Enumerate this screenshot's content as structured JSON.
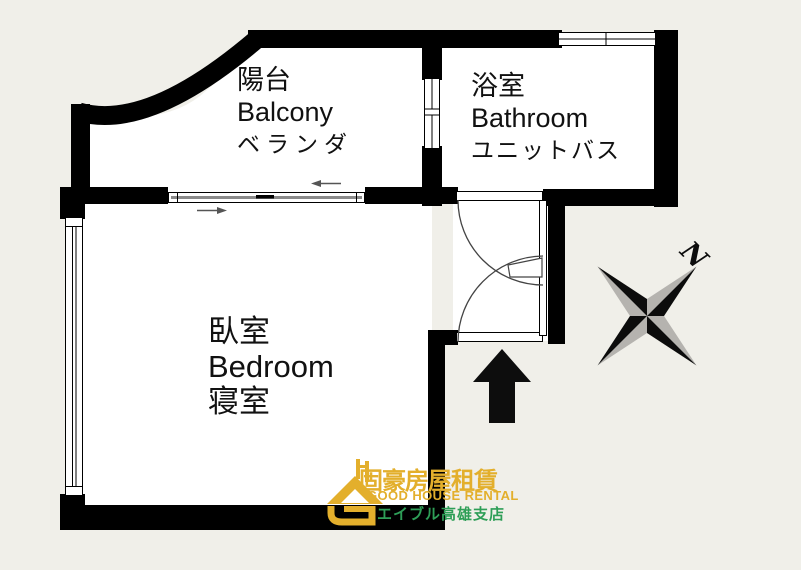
{
  "page": {
    "type": "apartment-floor-plan"
  },
  "rooms": {
    "balcony": {
      "zh": "陽台",
      "en": "Balcony",
      "ja": "ベランダ"
    },
    "bathroom": {
      "zh": "浴室",
      "en": "Bathroom",
      "ja": "ユニットバス"
    },
    "bedroom": {
      "zh": "臥室",
      "en": "Bedroom",
      "ja": "寝室"
    }
  },
  "compass": {
    "label": "N"
  },
  "logo": {
    "title_zh": "固豪房屋租賃",
    "title_en": "GOOD HOUSE RENTAL",
    "branch_ja": "エイブル高雄支店"
  },
  "colors": {
    "background": "#f0efe9",
    "wall": "#000000",
    "floor": "#ffffff",
    "compass_gray": "#b5b3af",
    "logo_gold": "#e3af2c",
    "logo_green": "#2e9e57"
  }
}
